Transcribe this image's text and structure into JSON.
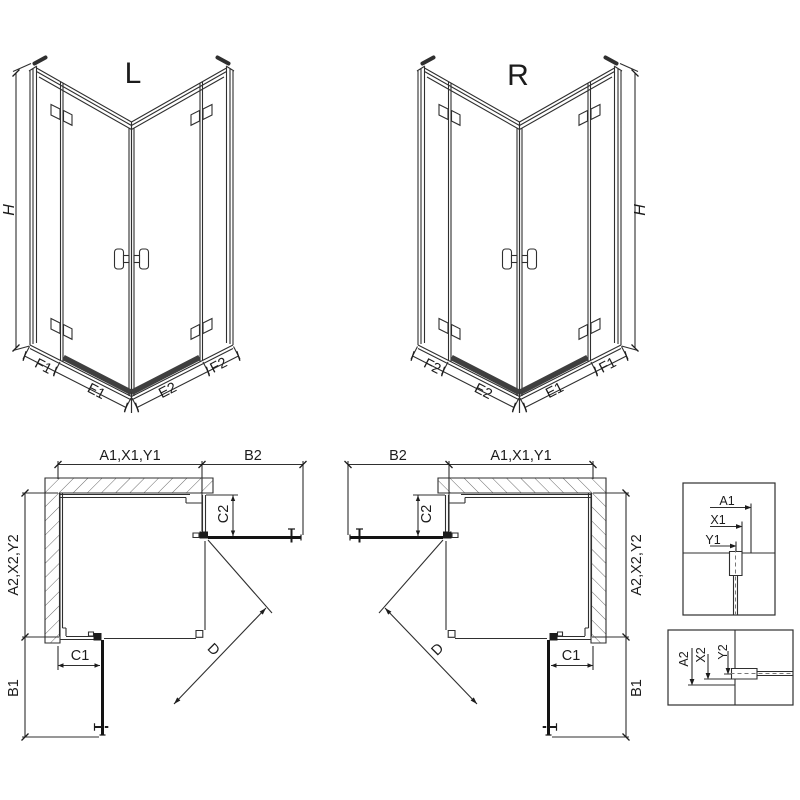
{
  "drawing": {
    "iso_left": {
      "title": "L",
      "height": "H",
      "segs": [
        "F1",
        "E1",
        "E2",
        "F2"
      ]
    },
    "iso_right": {
      "title": "R",
      "height": "H",
      "segs": [
        "F2",
        "E2",
        "E1",
        "F1"
      ]
    },
    "plan_left": {
      "width_top": "A1,X1,Y1",
      "door_top": "B2",
      "return_top": "C2",
      "side": "A2,X2,Y2",
      "return_bottom": "C1",
      "door_bottom": "B1",
      "diagonal": "D"
    },
    "plan_right": {
      "width_top": "A1,X1,Y1",
      "door_top": "B2",
      "return_top": "C2",
      "side": "A2,X2,Y2",
      "return_bottom": "C1",
      "door_bottom": "B1",
      "diagonal": "D"
    },
    "detail_wall": {
      "dims": [
        "A1",
        "X1",
        "Y1"
      ]
    },
    "detail_floor": {
      "dims": [
        "A2",
        "X2",
        "Y2"
      ]
    }
  },
  "colors": {
    "line": "#2f2f2f",
    "dark": "#131313",
    "threshold": "#3f3f3f",
    "hatch": "#5a5a5a",
    "background": "#ffffff"
  }
}
